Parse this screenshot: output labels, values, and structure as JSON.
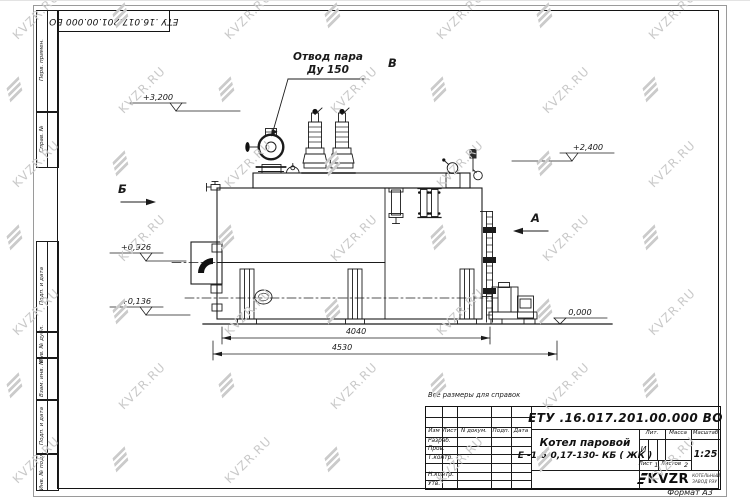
{
  "watermark": {
    "text": "KVZR.RU"
  },
  "colors": {
    "line": "#1b1b1b",
    "watermark": "#c9c9c9",
    "logo_black": "#111111"
  },
  "frame": {
    "doc_number_top": "ЕТУ .16.017.201.00.000  ВО",
    "margin_labels": [
      "Перв. примен.",
      "Справ. №",
      "Подп. и дата",
      "Инв. № дубл.",
      "Взам. инв. №",
      "Подп. и дата",
      "Инв. № подл."
    ],
    "format_note": "Формат А3"
  },
  "drawing": {
    "callout": {
      "line1": "Отвод пара",
      "line2": "Ду 150"
    },
    "views": {
      "b": "Б",
      "a": "А",
      "v": "В"
    },
    "elevations": {
      "e3200": "+3,200",
      "e2400": "+2,400",
      "e0926": "+0,926",
      "e0136": "+0,136",
      "e0000": "0,000"
    },
    "dimensions": {
      "d4040": "4040",
      "d4530": "4530"
    }
  },
  "title_block": {
    "note": "Все размеры для справок",
    "doc_number": "ЕТУ .16.017.201.00.000  ВО",
    "product_name_line1": "Котел паровой",
    "product_name_line2": "Е -1,6-0,17-130- КБ ( ЖК )",
    "col_headers": {
      "izm": "Изм",
      "list": "Лист",
      "ndocum": "N докум.",
      "podp": "Подп.",
      "data": "Дата"
    },
    "row_labels": {
      "razrab": "Разраб.",
      "prov": "Пров.",
      "tkontr": "Т.контр.",
      "nkontr": "Н.контр.",
      "utv": "Утв."
    },
    "section_headers": {
      "lit": "Лит.",
      "massa": "Масса",
      "masshtab": "Масштаб"
    },
    "lit_value": "И",
    "scale": "1:25",
    "sheet_label": "Лист",
    "sheet_value": "1",
    "sheets_label": "Листов",
    "sheets_value": "2",
    "company": {
      "logo_text": "KVZR",
      "sub_line1": "КОТЕЛЬНЫЙ",
      "sub_line2": "ЗАВОД РЭУ"
    }
  }
}
